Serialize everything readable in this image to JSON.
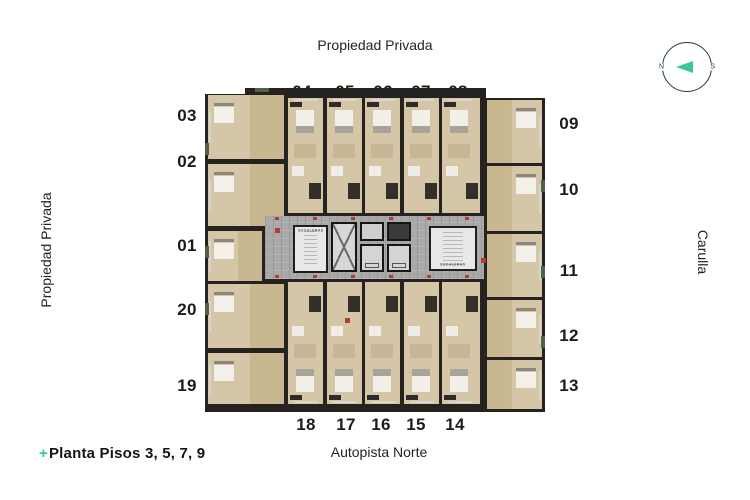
{
  "labels": {
    "top": "Propiedad Privada",
    "left": "Propiedad Privada",
    "right": "Carulla",
    "bottom": "Autopista Norte",
    "caption_prefix": "+",
    "caption": "Planta Pisos 3, 5, 7, 9"
  },
  "compass": {
    "west": "N",
    "east": "S"
  },
  "units": {
    "left": [
      "03",
      "02",
      "01",
      "20",
      "19"
    ],
    "top": [
      "04",
      "05",
      "06",
      "07",
      "08"
    ],
    "right": [
      "09",
      "10",
      "11",
      "12",
      "13"
    ],
    "bottom": [
      "18",
      "17",
      "16",
      "15",
      "14"
    ]
  },
  "core": {
    "stairs_left": "ESCALERAS",
    "stairs_right": "ESCALERAS"
  },
  "colors": {
    "accent": "#2fc5a8",
    "compass_ring": "#1d3c43",
    "wall": "#262220",
    "floor": "#d5c6a8",
    "wood": "#c9b78f",
    "corridor": "#a9a9a9",
    "marker": "#b13c2f"
  }
}
